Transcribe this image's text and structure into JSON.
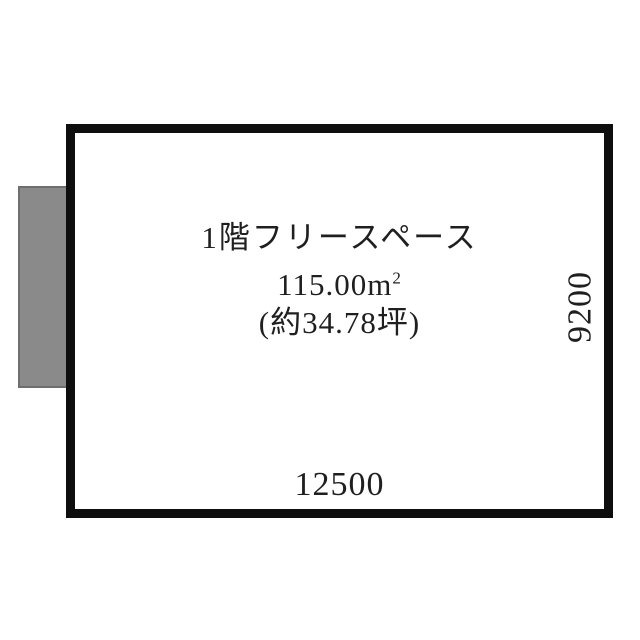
{
  "floorplan": {
    "room": {
      "name": "1階フリースペース",
      "area_value": "115.00",
      "area_unit_base": "m",
      "area_unit_sup": "2",
      "tsubo_label": "(約34.78坪)"
    },
    "dimensions": {
      "bottom_mm": "12500",
      "right_mm": "9200"
    },
    "colors": {
      "wall": "#0e0e0e",
      "text": "#1f1f1f",
      "annex_fill": "#8a8a8a",
      "annex_border": "#6e6e6e",
      "background": "#ffffff"
    }
  }
}
